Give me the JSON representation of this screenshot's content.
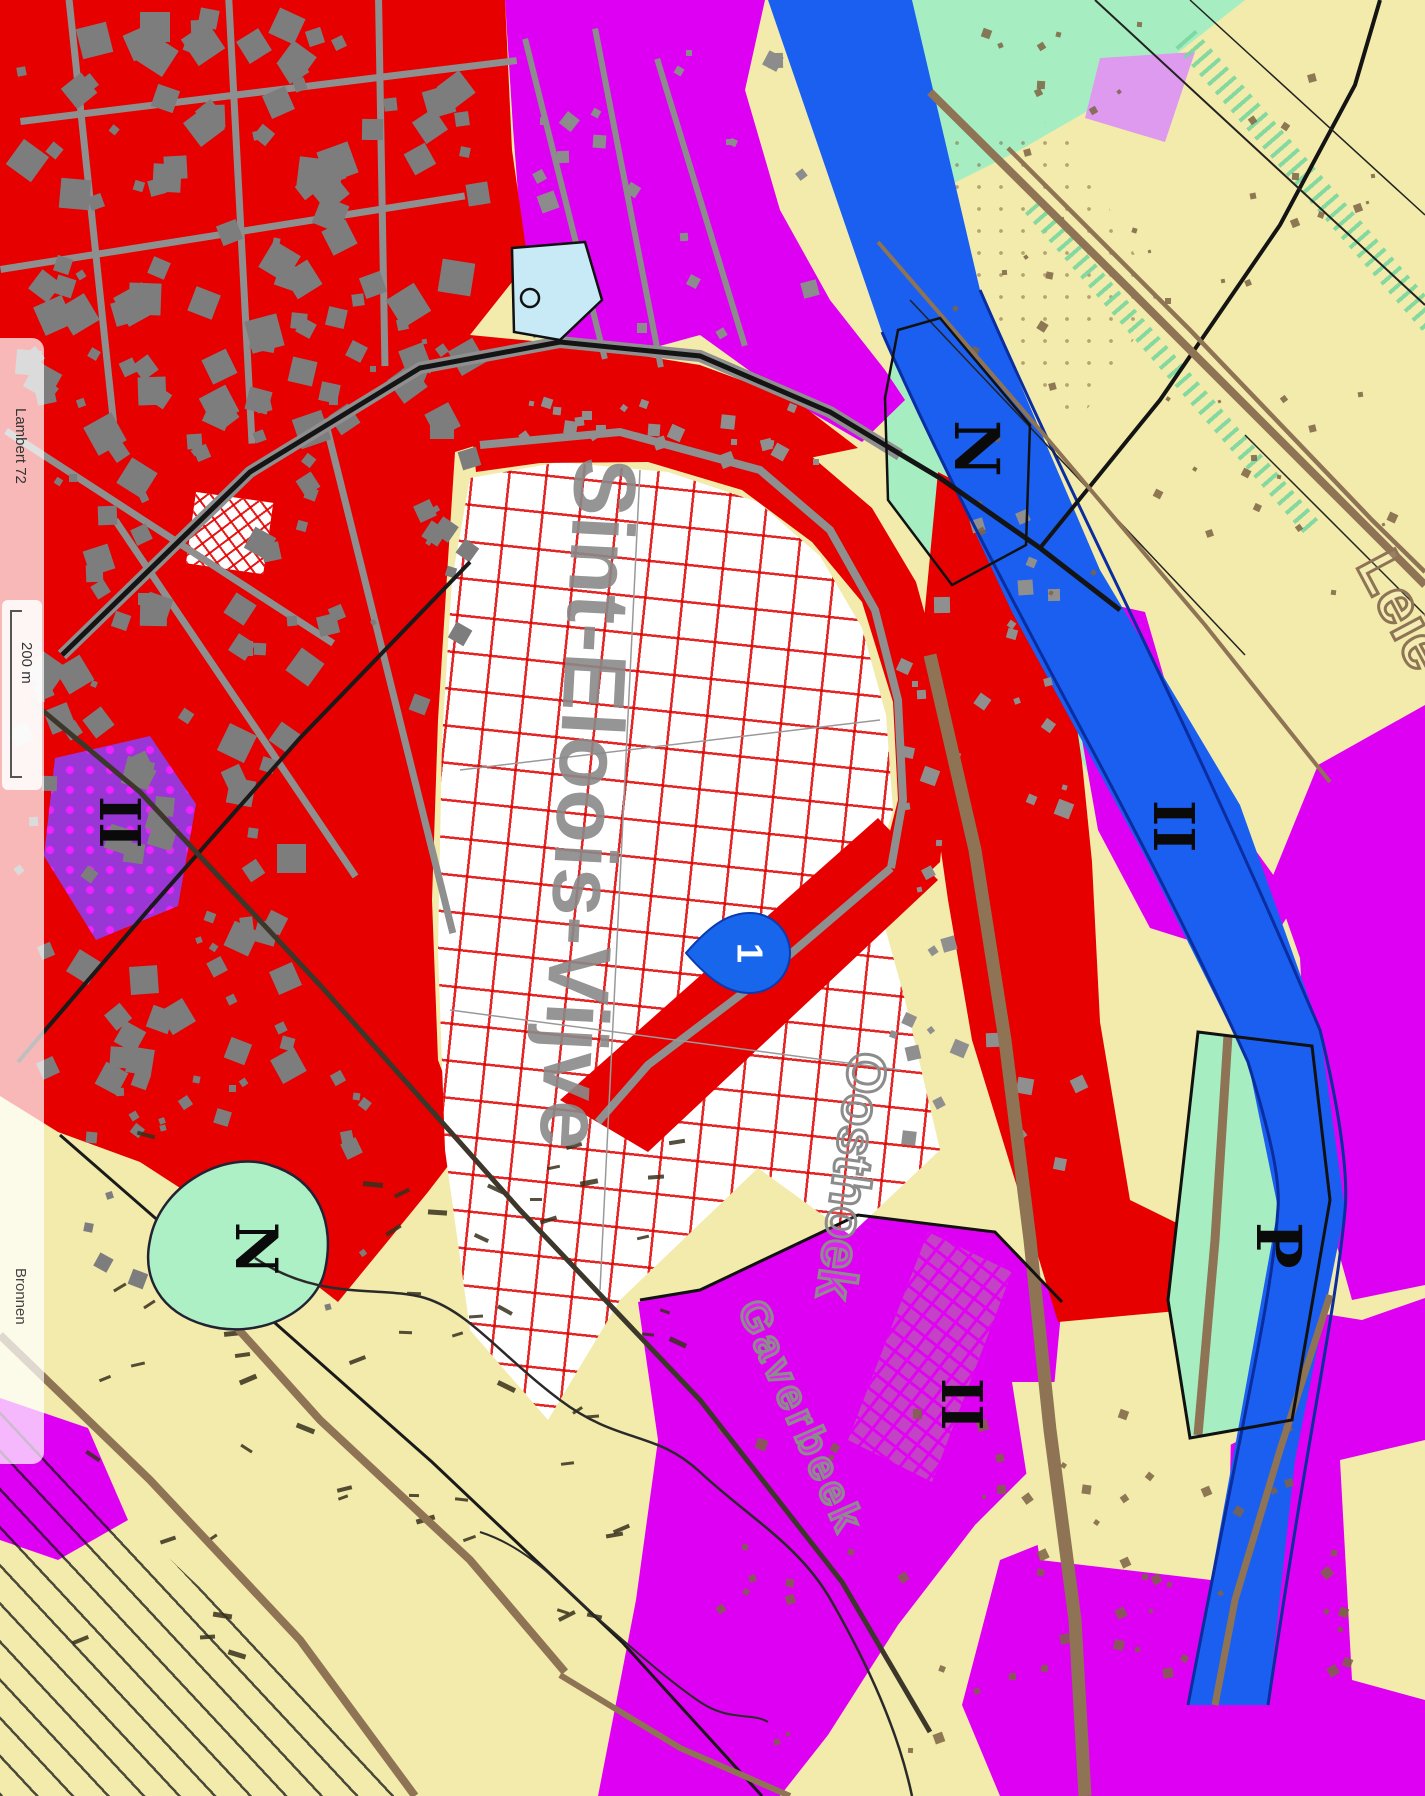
{
  "viewer_footer": {
    "projection_label": "Lambert 72",
    "scale_bar_label": "200 m",
    "sources_label": "Bronnen"
  },
  "map": {
    "marker": {
      "label": "1"
    },
    "place_labels": [
      {
        "id": "main-town",
        "text": "Sint-Eloois-Vijve"
      },
      {
        "id": "hamlet",
        "text": "Oosthoek"
      },
      {
        "id": "stream",
        "text": "Gaverbeek"
      },
      {
        "id": "river",
        "text": "Leie"
      }
    ],
    "zone_labels": [
      {
        "id": "nature-north",
        "text": "N"
      },
      {
        "id": "nature-southwest",
        "text": "N"
      },
      {
        "id": "park-southeast",
        "text": "P"
      },
      {
        "id": "zone-ii-west",
        "text": "II"
      },
      {
        "id": "zone-ii-east",
        "text": "II"
      },
      {
        "id": "zone-ii-south",
        "text": "II"
      }
    ],
    "legend_colors": {
      "residential_red": "#e60000",
      "industrial_magenta": "#de00f2",
      "agricultural_yellow": "#f2ebab",
      "nature_green": "#a6eec1",
      "water_blue": "#1b5ff0",
      "buildings_gray": "#7d7d7d",
      "roads_brown": "#8e7355",
      "expansion_hatch_red": "#dd0000"
    }
  }
}
